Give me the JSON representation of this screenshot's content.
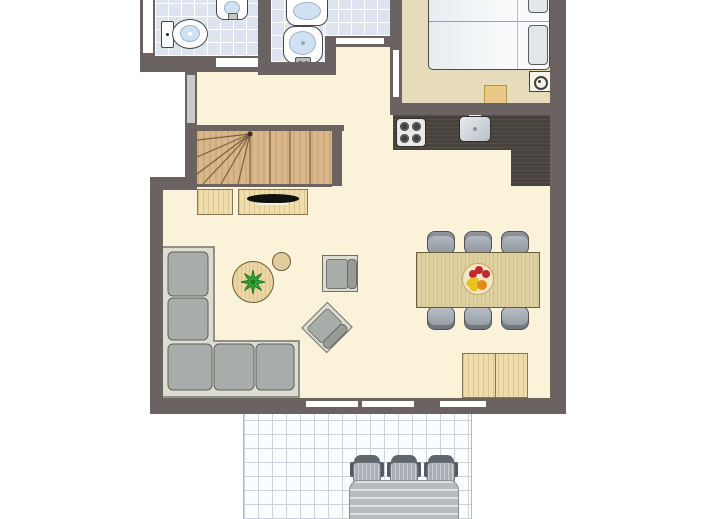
{
  "type": "floor-plan",
  "title": "holiday-home-ground-floor-plan",
  "visible_text": [],
  "colors": {
    "wall": "#6b6361",
    "floor_main": "#faf3da",
    "floor_bedroom": "#e7dcba",
    "bathroom_tile": "#dde4f0",
    "terrace_tile": "#fbfcfe",
    "stairs_wood": "#d9b78a",
    "cabinet_wood": "#efddab",
    "dining_table_wood": "#dfd2a2",
    "kitchen_counter": "#48423d",
    "sofa_gray": "#a9ada9",
    "chair_gray": "#9da4ad",
    "water_blue": "#cfe1f3",
    "plant_green": "#3aa23a",
    "fruit_red": "#c2272d",
    "fruit_yellow": "#e8c11c",
    "fruit_orange": "#e08a1a"
  },
  "rooms": [
    {
      "name": "wc",
      "fixtures": [
        "toilet",
        "small-sink",
        "door"
      ]
    },
    {
      "name": "bathroom",
      "fixtures": [
        "washbasin",
        "pedestal-basin",
        "door",
        "window"
      ]
    },
    {
      "name": "hallway",
      "fixtures": [
        "entrance-door",
        "staircase"
      ]
    },
    {
      "name": "bedroom",
      "fixtures": [
        "double-bed",
        "two-pillows",
        "stool",
        "lamp",
        "door"
      ]
    },
    {
      "name": "kitchen",
      "fixtures": [
        "l-shaped-counter",
        "stove-4-burners",
        "kitchen-sink"
      ]
    },
    {
      "name": "dining-area",
      "fixtures": [
        "dining-table",
        "six-chairs",
        "fruit-bowl",
        "sideboard-cabinet"
      ]
    },
    {
      "name": "living-room",
      "fixtures": [
        "corner-sofa",
        "coffee-table",
        "plant",
        "side-table",
        "armchair",
        "rotated-armchair",
        "tv-cabinet",
        "cabinet",
        "sliding-door",
        "windows"
      ]
    },
    {
      "name": "terrace",
      "fixtures": [
        "garden-table",
        "three-garden-chairs",
        "tiled-floor"
      ]
    }
  ]
}
